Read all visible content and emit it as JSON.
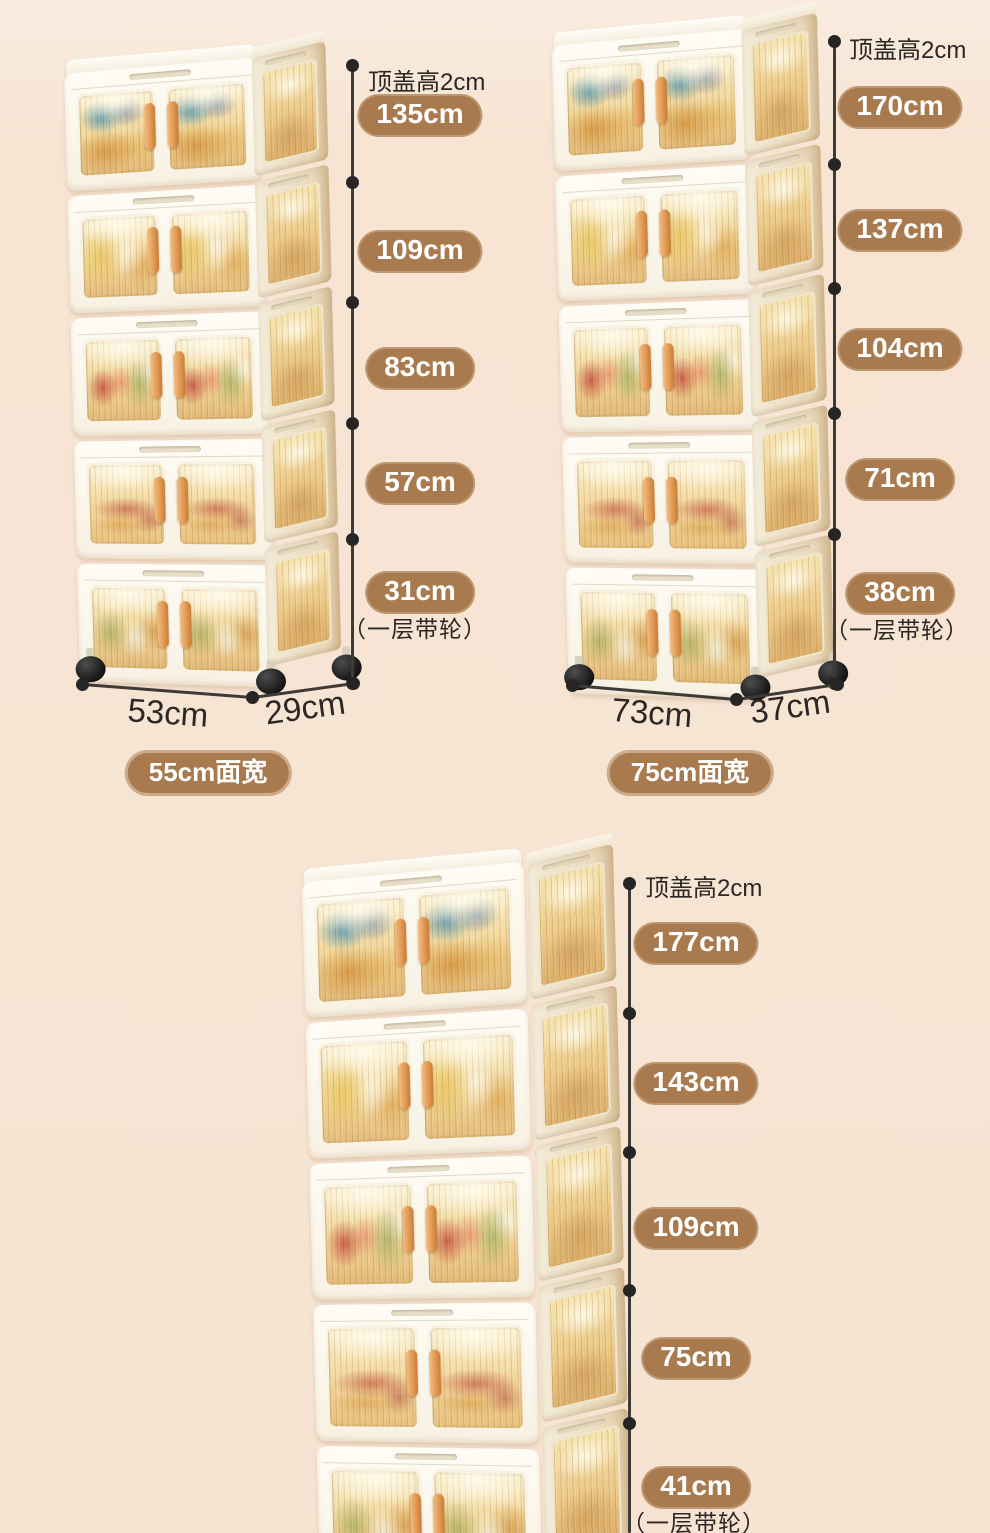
{
  "colors": {
    "background": "#f7e5d4",
    "badge": "#a87a4d",
    "badge_text": "#ffffff",
    "annotation_text": "#2b2724",
    "dimension_line": "#3d3b38",
    "cabinet_frame": "#fdfaf2",
    "handle": "#e09a55"
  },
  "cabinets": [
    {
      "name": "5-tier folding storage cabinet 55cm",
      "top_cap_note": "顶盖高2cm",
      "tier_heights": [
        "135cm",
        "109cm",
        "83cm",
        "57cm",
        "31cm"
      ],
      "wheel_note": "（一层带轮）",
      "front_width": "53cm",
      "side_depth": "29cm",
      "width_badge": "55cm面宽"
    },
    {
      "name": "5-tier folding storage cabinet 75cm",
      "top_cap_note": "顶盖高2cm",
      "tier_heights": [
        "170cm",
        "137cm",
        "104cm",
        "71cm",
        "38cm"
      ],
      "wheel_note": "（一层带轮）",
      "front_width": "73cm",
      "side_depth": "37cm",
      "width_badge": "75cm面宽"
    },
    {
      "name": "5-tier folding storage cabinet large",
      "top_cap_note": "顶盖高2cm",
      "tier_heights": [
        "177cm",
        "143cm",
        "109cm",
        "75cm",
        "41cm"
      ],
      "wheel_note": "（一层带轮）"
    }
  ]
}
